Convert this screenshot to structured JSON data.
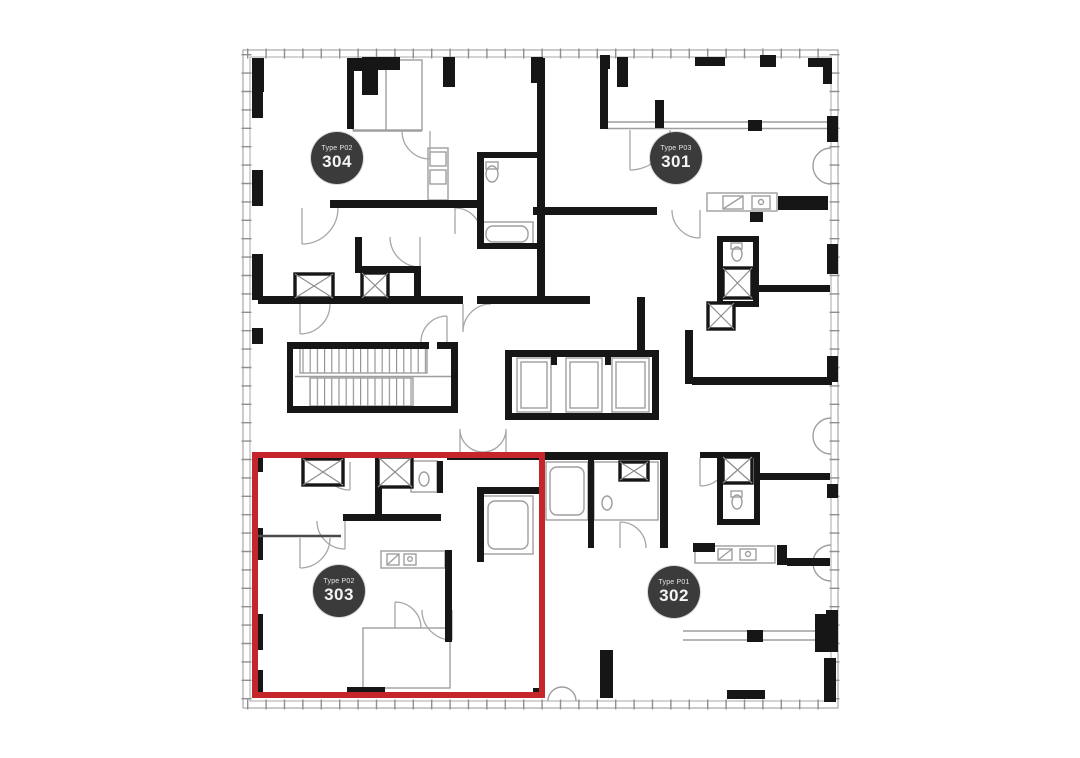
{
  "page": {
    "background": "#ffffff",
    "view": "floor-plan-level-3"
  },
  "floorplan": {
    "selected_unit": "303",
    "colors": {
      "highlight": "#c4262b",
      "walls": "#161616",
      "thin_lines": "#9e9e9e",
      "badge_bg": "#3b3b3b",
      "badge_text": "#f4f4f4"
    },
    "units": [
      {
        "id": "304",
        "type_label": "Type P02",
        "number": "304",
        "selected": false
      },
      {
        "id": "301",
        "type_label": "Type P03",
        "number": "301",
        "selected": false
      },
      {
        "id": "303",
        "type_label": "Type P02",
        "number": "303",
        "selected": true
      },
      {
        "id": "302",
        "type_label": "Type P01",
        "number": "302",
        "selected": false
      }
    ],
    "features": [
      "staircase",
      "elevator-bank-3-cars",
      "shafts",
      "bathrooms",
      "kitchens"
    ]
  }
}
